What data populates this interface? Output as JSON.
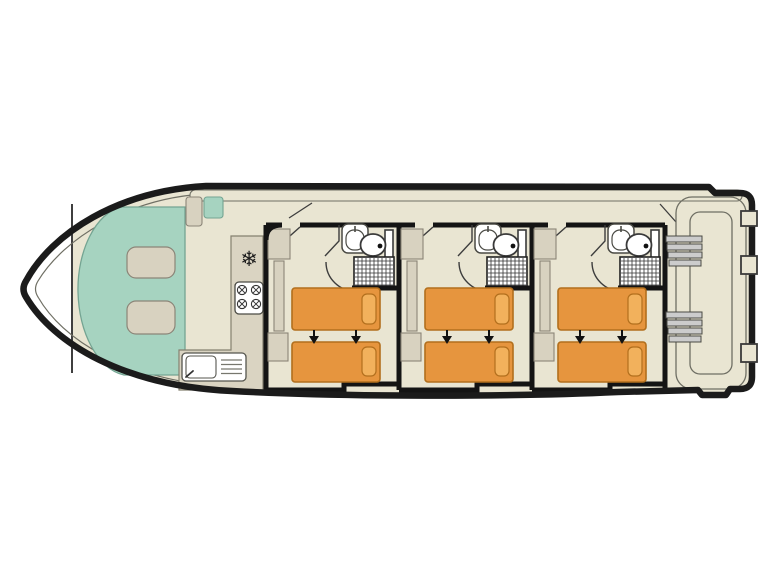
{
  "page": {
    "type": "boat-deck-plan",
    "background": "#ffffff"
  },
  "colors": {
    "hull_outline": "#1b1b1b",
    "deck": "#e9e5d2",
    "lounge_teal": "#a6d3c0",
    "furniture_beige": "#d8d2c0",
    "counter": "#dad4c2",
    "bed": "#e6953e",
    "pillow": "#f2b15c",
    "bed_outline": "#b26f1d",
    "wall": "#141414",
    "stair_tread": "#cccccc",
    "fixture_white": "#ffffff",
    "thin_line": "#6f6f64"
  },
  "boat": {
    "bow": {
      "lounge_seating": 1,
      "lounge_tables": 2,
      "small_bench": 1,
      "small_seat_cushion": 1
    },
    "galley": {
      "fixtures": [
        {
          "name": "refrigerator",
          "icon": "snowflake-icon"
        },
        {
          "name": "hob",
          "burners": 4
        },
        {
          "name": "sink",
          "drainer": true
        }
      ]
    },
    "corridor": {
      "cabin_doors": 3
    },
    "cabins": [
      {
        "id": "cabin-1",
        "beds": 2,
        "pillows": 2,
        "convertible_arrows": 2,
        "wardrobe": true,
        "bathroom": {
          "sink": true,
          "toilet": true,
          "shower": true
        }
      },
      {
        "id": "cabin-2",
        "beds": 2,
        "pillows": 2,
        "convertible_arrows": 2,
        "wardrobe": true,
        "bathroom": {
          "sink": true,
          "toilet": true,
          "shower": true
        }
      },
      {
        "id": "cabin-3",
        "beds": 2,
        "pillows": 2,
        "convertible_arrows": 2,
        "wardrobe": true,
        "bathroom": {
          "sink": true,
          "toilet": true,
          "shower": true
        }
      }
    ],
    "stern": {
      "staircases": 2,
      "steps_per_staircase": 4,
      "boarding_gates": 3,
      "walkway_rail": true
    }
  },
  "glyphs": {
    "snowflake": "❄"
  }
}
